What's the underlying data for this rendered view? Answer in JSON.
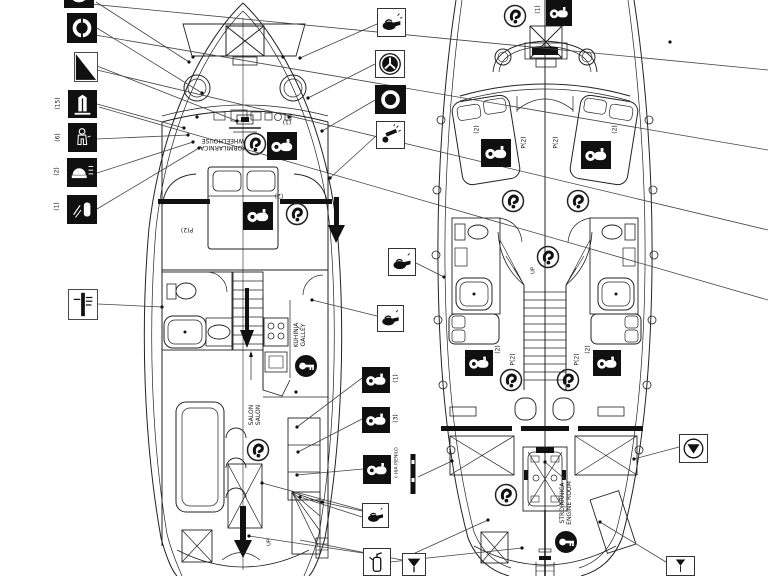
{
  "colors": {
    "ink": "#1c1c1c",
    "bg": "#ffffff"
  },
  "left_legend": {
    "lifejacket_count": "(15)",
    "immersion_suit_count": "(6)",
    "liferaft_count": "(2)",
    "beacon_count": "(1)"
  },
  "mid_legend": {
    "ext_a_count": "(1)",
    "ext_b_count": "(3)",
    "foam_label": "(-)6A PJENILO"
  },
  "left_boat": {
    "wheelhouse_line1": "KORMILARNICA",
    "wheelhouse_line2": "WHEELHOUSE",
    "wheelhouse_ext_count": "(1)",
    "cabin_berths": "P(2)",
    "cabin_ext_count": "(2)",
    "galley_line1": "KUHINJA",
    "galley_line2": "GALLEY",
    "salon_line1": "SALON",
    "salon_line2": "SALON",
    "stairs_up": "UP"
  },
  "right_boat": {
    "bow_ext_count": "(1)",
    "fwd_port_berths": "P(2)",
    "fwd_stbd_berths": "P(2)",
    "fwd_port_ext_count": "(2)",
    "fwd_stbd_ext_count": "(2)",
    "aft_port_berths": "P(2)",
    "aft_stbd_berths": "P(2)",
    "aft_port_ext_count": "(2)",
    "aft_stbd_ext_count": "(2)",
    "stairs_up": "UP",
    "engine_line1": "STROJARNICA",
    "engine_line2": "ENGINE ROOM"
  }
}
